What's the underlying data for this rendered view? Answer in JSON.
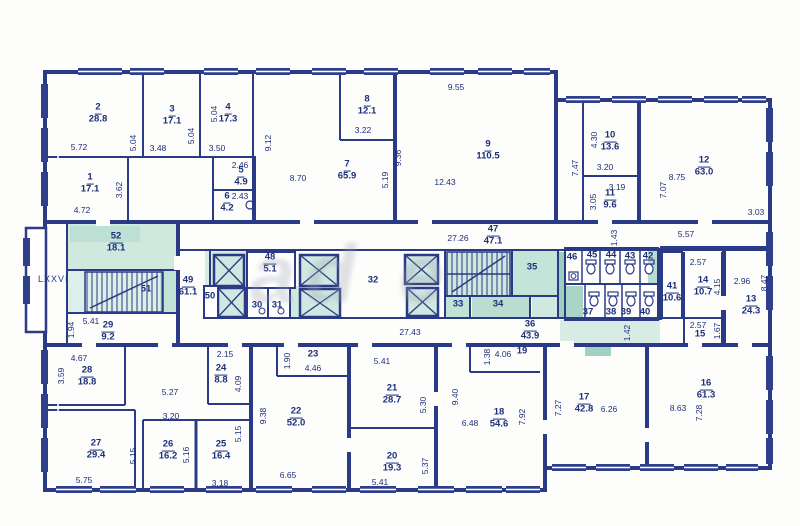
{
  "watermark": {
    "text": "ad e"
  },
  "colors": {
    "line": "#2a3a86",
    "text": "#1d2f7b",
    "teal": "#cfe8e0",
    "teal_dark": "#a8d5c6",
    "paper": "#ffffff"
  },
  "plan": {
    "section_label": "LXXVI",
    "rooms": [
      {
        "n": "1",
        "a": "17.1",
        "x": 90,
        "y": 184
      },
      {
        "n": "2",
        "a": "28.8",
        "x": 98,
        "y": 114
      },
      {
        "n": "3",
        "a": "17.1",
        "x": 172,
        "y": 116
      },
      {
        "n": "4",
        "a": "17.3",
        "x": 228,
        "y": 114
      },
      {
        "n": "5",
        "a": "4.9",
        "x": 241,
        "y": 177
      },
      {
        "n": "6",
        "a": "4.2",
        "x": 227,
        "y": 203
      },
      {
        "n": "7",
        "a": "65.9",
        "x": 347,
        "y": 171
      },
      {
        "n": "8",
        "a": "12.1",
        "x": 367,
        "y": 106
      },
      {
        "n": "9",
        "a": "110.5",
        "x": 488,
        "y": 151
      },
      {
        "n": "10",
        "a": "13.6",
        "x": 610,
        "y": 142
      },
      {
        "n": "11",
        "a": "9.6",
        "x": 610,
        "y": 200
      },
      {
        "n": "12",
        "a": "63.0",
        "x": 704,
        "y": 167
      },
      {
        "n": "13",
        "a": "24.3",
        "x": 751,
        "y": 306
      },
      {
        "n": "14",
        "a": "10.7",
        "x": 703,
        "y": 287
      },
      {
        "n": "15",
        "x": 700,
        "y": 335
      },
      {
        "n": "16",
        "a": "61.3",
        "x": 706,
        "y": 390
      },
      {
        "n": "17",
        "a": "42.8",
        "x": 584,
        "y": 404
      },
      {
        "n": "18",
        "a": "54.6",
        "x": 499,
        "y": 419
      },
      {
        "n": "19",
        "x": 522,
        "y": 352
      },
      {
        "n": "20",
        "a": "19.3",
        "x": 392,
        "y": 463
      },
      {
        "n": "21",
        "a": "28.7",
        "x": 392,
        "y": 395
      },
      {
        "n": "22",
        "a": "52.0",
        "x": 296,
        "y": 418
      },
      {
        "n": "23",
        "x": 313,
        "y": 355
      },
      {
        "n": "24",
        "a": "8.8",
        "x": 221,
        "y": 375
      },
      {
        "n": "25",
        "a": "16.4",
        "x": 221,
        "y": 451
      },
      {
        "n": "26",
        "a": "16.2",
        "x": 168,
        "y": 451
      },
      {
        "n": "27",
        "a": "29.4",
        "x": 96,
        "y": 450
      },
      {
        "n": "28",
        "a": "18.8",
        "x": 87,
        "y": 377
      },
      {
        "n": "29",
        "a": "9.2",
        "x": 108,
        "y": 332
      },
      {
        "n": "30",
        "x": 257,
        "y": 306
      },
      {
        "n": "31",
        "x": 277,
        "y": 306
      },
      {
        "n": "32",
        "x": 373,
        "y": 281
      },
      {
        "n": "33",
        "x": 458,
        "y": 305
      },
      {
        "n": "34",
        "x": 498,
        "y": 305
      },
      {
        "n": "35",
        "x": 532,
        "y": 268
      },
      {
        "n": "36",
        "a": "43.9",
        "x": 530,
        "y": 331
      },
      {
        "n": "37",
        "x": 588,
        "y": 313
      },
      {
        "n": "38",
        "x": 611,
        "y": 313
      },
      {
        "n": "39",
        "x": 626,
        "y": 313
      },
      {
        "n": "40",
        "x": 645,
        "y": 313
      },
      {
        "n": "41",
        "a": "10.6",
        "x": 672,
        "y": 293
      },
      {
        "n": "42",
        "x": 648,
        "y": 257
      },
      {
        "n": "43",
        "x": 630,
        "y": 257
      },
      {
        "n": "44",
        "x": 611,
        "y": 256
      },
      {
        "n": "45",
        "x": 592,
        "y": 256
      },
      {
        "n": "46",
        "x": 572,
        "y": 258
      },
      {
        "n": "47",
        "a": "47.1",
        "x": 493,
        "y": 236
      },
      {
        "n": "48",
        "a": "5.1",
        "x": 270,
        "y": 264
      },
      {
        "n": "49",
        "a": "61.1",
        "x": 188,
        "y": 287
      },
      {
        "n": "50",
        "x": 210,
        "y": 297
      },
      {
        "n": "51",
        "x": 146,
        "y": 290
      },
      {
        "n": "52",
        "a": "18.1",
        "x": 116,
        "y": 243
      }
    ],
    "dims": [
      {
        "t": "5.72",
        "x": 79,
        "y": 147
      },
      {
        "t": "5.04",
        "x": 133,
        "y": 143,
        "v": 1
      },
      {
        "t": "3.48",
        "x": 158,
        "y": 148
      },
      {
        "t": "5.04",
        "x": 191,
        "y": 136,
        "v": 1
      },
      {
        "t": "3.50",
        "x": 217,
        "y": 148
      },
      {
        "t": "5.04",
        "x": 214,
        "y": 114,
        "v": 1
      },
      {
        "t": "9.12",
        "x": 268,
        "y": 143,
        "v": 1
      },
      {
        "t": "3.62",
        "x": 119,
        "y": 190,
        "v": 1
      },
      {
        "t": "4.72",
        "x": 82,
        "y": 210
      },
      {
        "t": "2.46",
        "x": 240,
        "y": 165
      },
      {
        "t": "2.43",
        "x": 240,
        "y": 196
      },
      {
        "t": "8.70",
        "x": 298,
        "y": 178
      },
      {
        "t": "3.22",
        "x": 363,
        "y": 130
      },
      {
        "t": "9.36",
        "x": 398,
        "y": 158,
        "v": 1
      },
      {
        "t": "5.19",
        "x": 385,
        "y": 180,
        "v": 1
      },
      {
        "t": "9.55",
        "x": 456,
        "y": 87
      },
      {
        "t": "12.43",
        "x": 445,
        "y": 182
      },
      {
        "t": "7.47",
        "x": 575,
        "y": 168,
        "v": 1
      },
      {
        "t": "4.30",
        "x": 594,
        "y": 140,
        "v": 1
      },
      {
        "t": "3.20",
        "x": 605,
        "y": 167
      },
      {
        "t": "3.19",
        "x": 617,
        "y": 187
      },
      {
        "t": "3.05",
        "x": 593,
        "y": 202,
        "v": 1
      },
      {
        "t": "8.75",
        "x": 677,
        "y": 177
      },
      {
        "t": "7.07",
        "x": 663,
        "y": 190,
        "v": 1
      },
      {
        "t": "3.03",
        "x": 756,
        "y": 212
      },
      {
        "t": "5.57",
        "x": 686,
        "y": 234
      },
      {
        "t": "27.26",
        "x": 458,
        "y": 238
      },
      {
        "t": "1.43",
        "x": 614,
        "y": 238,
        "v": 1
      },
      {
        "t": "2.57",
        "x": 698,
        "y": 262
      },
      {
        "t": "4.15",
        "x": 717,
        "y": 287,
        "v": 1
      },
      {
        "t": "2.96",
        "x": 742,
        "y": 281
      },
      {
        "t": "8.47",
        "x": 764,
        "y": 283,
        "v": 1
      },
      {
        "t": "2.57",
        "x": 698,
        "y": 325
      },
      {
        "t": "1.67",
        "x": 717,
        "y": 331,
        "v": 1
      },
      {
        "t": "5.41",
        "x": 91,
        "y": 321
      },
      {
        "t": "1.94",
        "x": 71,
        "y": 330,
        "v": 1
      },
      {
        "t": "27.43",
        "x": 410,
        "y": 332
      },
      {
        "t": "1.42",
        "x": 627,
        "y": 333,
        "v": 1
      },
      {
        "t": "2.15",
        "x": 225,
        "y": 354
      },
      {
        "t": "4.67",
        "x": 79,
        "y": 358
      },
      {
        "t": "3.59",
        "x": 61,
        "y": 376,
        "v": 1
      },
      {
        "t": "5.27",
        "x": 170,
        "y": 392
      },
      {
        "t": "4.09",
        "x": 238,
        "y": 384,
        "v": 1
      },
      {
        "t": "3.20",
        "x": 171,
        "y": 416
      },
      {
        "t": "5.16",
        "x": 186,
        "y": 455,
        "v": 1
      },
      {
        "t": "5.15",
        "x": 238,
        "y": 434,
        "v": 1
      },
      {
        "t": "3.18",
        "x": 220,
        "y": 483
      },
      {
        "t": "5.75",
        "x": 84,
        "y": 480
      },
      {
        "t": "5.15",
        "x": 133,
        "y": 456,
        "v": 1
      },
      {
        "t": "1.90",
        "x": 287,
        "y": 361,
        "v": 1
      },
      {
        "t": "4.46",
        "x": 313,
        "y": 368
      },
      {
        "t": "9.38",
        "x": 263,
        "y": 416,
        "v": 1
      },
      {
        "t": "6.65",
        "x": 288,
        "y": 475
      },
      {
        "t": "5.41",
        "x": 382,
        "y": 361
      },
      {
        "t": "5.30",
        "x": 423,
        "y": 405,
        "v": 1
      },
      {
        "t": "5.41",
        "x": 380,
        "y": 482
      },
      {
        "t": "5.37",
        "x": 425,
        "y": 466,
        "v": 1
      },
      {
        "t": "9.40",
        "x": 455,
        "y": 397,
        "v": 1
      },
      {
        "t": "4.06",
        "x": 503,
        "y": 354
      },
      {
        "t": "1.38",
        "x": 487,
        "y": 357,
        "v": 1
      },
      {
        "t": "6.48",
        "x": 470,
        "y": 423
      },
      {
        "t": "7.92",
        "x": 522,
        "y": 417,
        "v": 1
      },
      {
        "t": "7.27",
        "x": 558,
        "y": 408,
        "v": 1
      },
      {
        "t": "6.26",
        "x": 609,
        "y": 409
      },
      {
        "t": "8.63",
        "x": 678,
        "y": 408
      },
      {
        "t": "7.28",
        "x": 699,
        "y": 413,
        "v": 1
      }
    ]
  }
}
